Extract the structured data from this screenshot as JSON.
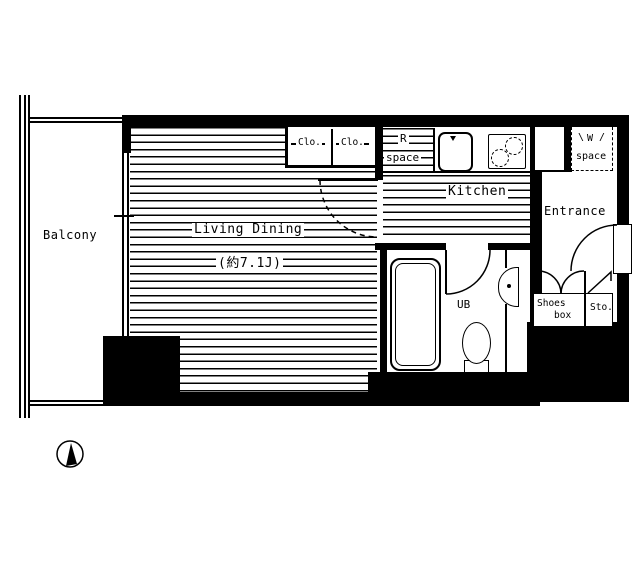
{
  "plan": {
    "title": "apartment-floor-plan",
    "colors": {
      "line": "#000000",
      "background": "#ffffff"
    },
    "rooms": {
      "balcony": {
        "label": "Balcony"
      },
      "living": {
        "label": "Living Dining",
        "area": "(約7.1J)"
      },
      "kitchen": {
        "label": "Kitchen"
      },
      "entrance": {
        "label": "Entrance"
      },
      "bath": {
        "label": "UB"
      },
      "closet1": {
        "label": "Clo."
      },
      "closet2": {
        "label": "Clo."
      },
      "r_space": {
        "line1": "R",
        "line2": "space"
      },
      "w_space": {
        "line1": "W",
        "line2": "space",
        "tick_left": "\\",
        "tick_right": "/"
      },
      "shoes_box": {
        "line1": "Shoes",
        "line2": "box"
      },
      "storage": {
        "label": "Sto."
      }
    }
  }
}
